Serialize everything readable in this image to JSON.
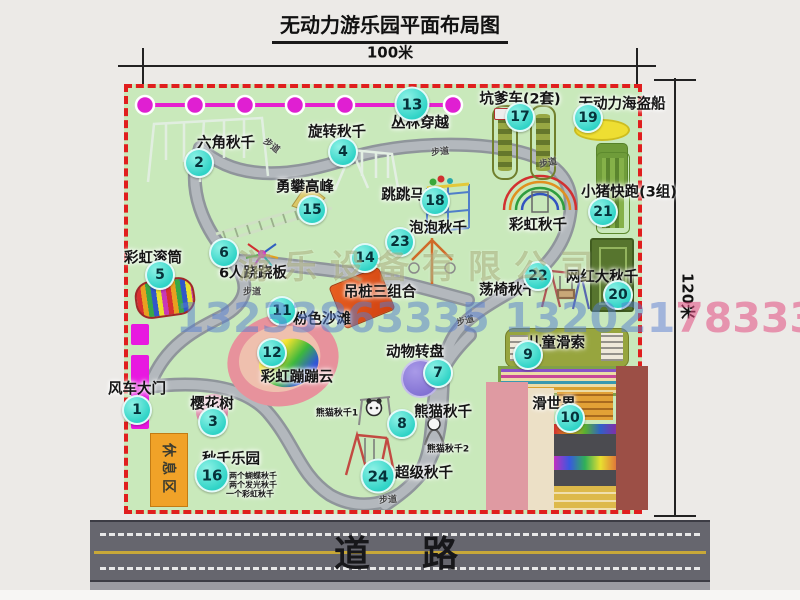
{
  "title": "无动力游乐园平面布局图",
  "dimensions": {
    "width": "100米",
    "height": "120米"
  },
  "road": {
    "label": "道　路"
  },
  "watermark": {
    "company": "游乐设备有限公司",
    "phone_main": "13233863335 132021",
    "phone_tail": "78333"
  },
  "map": {
    "trail_label": "步道",
    "rest_area": "休息区",
    "rainbow_swing": "彩虹秋千",
    "panda_notes": [
      "熊猫秋千1",
      "熊猫秋千2"
    ],
    "swing_park_notes": [
      "两个蝴蝶秋千",
      "两个发光秋千",
      "一个彩虹秋千"
    ],
    "colors": {
      "map_bg": "#c9e9bb",
      "border": "#e01e1e",
      "badge": "#2fd3c6",
      "zipline": "#e520cf",
      "road": "#66666e",
      "gate": "#e818e0"
    },
    "attractions": [
      {
        "num": "1",
        "name": "风车大门"
      },
      {
        "num": "2",
        "name": "六角秋千"
      },
      {
        "num": "3",
        "name": "樱花树"
      },
      {
        "num": "4",
        "name": "旋转秋千"
      },
      {
        "num": "5",
        "name": "彩虹滚筒"
      },
      {
        "num": "6",
        "name": "6人跷跷板"
      },
      {
        "num": "7",
        "name": "动物转盘"
      },
      {
        "num": "8",
        "name": "熊猫秋千"
      },
      {
        "num": "9",
        "name": "儿童滑索"
      },
      {
        "num": "10",
        "name": "滑世界"
      },
      {
        "num": "11",
        "name": "粉色沙滩"
      },
      {
        "num": "12",
        "name": "彩虹蹦蹦云"
      },
      {
        "num": "13",
        "name": "丛林穿越"
      },
      {
        "num": "14",
        "name": "吊桩三组合"
      },
      {
        "num": "15",
        "name": "勇攀高峰"
      },
      {
        "num": "16",
        "name": "秋千乐园"
      },
      {
        "num": "17",
        "name": "坑爹车(2套)"
      },
      {
        "num": "18",
        "name": "跳跳马"
      },
      {
        "num": "19",
        "name": "无动力海盗船"
      },
      {
        "num": "20",
        "name": "网红大秋千"
      },
      {
        "num": "21",
        "name": "小猪快跑(3组)"
      },
      {
        "num": "22",
        "name": "荡椅秋千"
      },
      {
        "num": "23",
        "name": "泡泡秋千"
      },
      {
        "num": "24",
        "name": "超级秋千"
      }
    ]
  }
}
